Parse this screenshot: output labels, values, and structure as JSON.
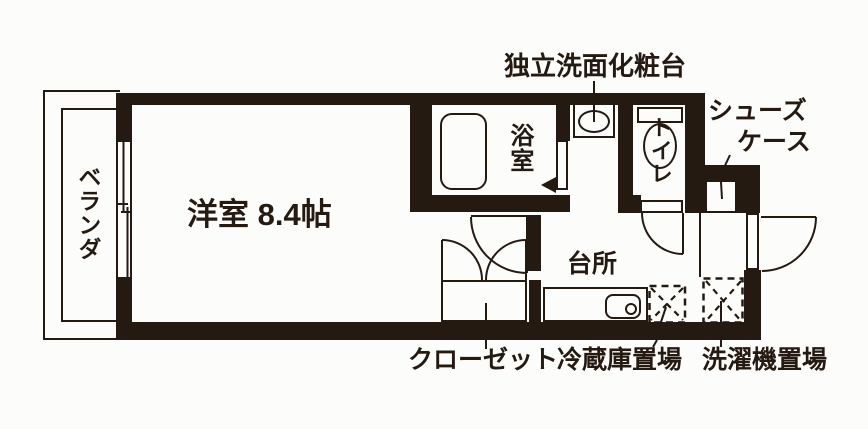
{
  "meta": {
    "drawing_type": "apartment floor plan"
  },
  "colors": {
    "ink": "#251a12",
    "paper": "#fcfcfa"
  },
  "rooms": {
    "balcony": "ベランダ",
    "main_room": "洋室 8.4帖",
    "bathroom": "浴室",
    "toilet": "トイレ",
    "kitchen": "台所"
  },
  "annotations": {
    "vanity": "独立洗面化粧台",
    "shoe_case_line1": "シューズ",
    "shoe_case_line2": "ケース",
    "closet": "クローゼット",
    "fridge_space": "冷蔵庫置場",
    "washer_space": "洗濯機置場"
  }
}
